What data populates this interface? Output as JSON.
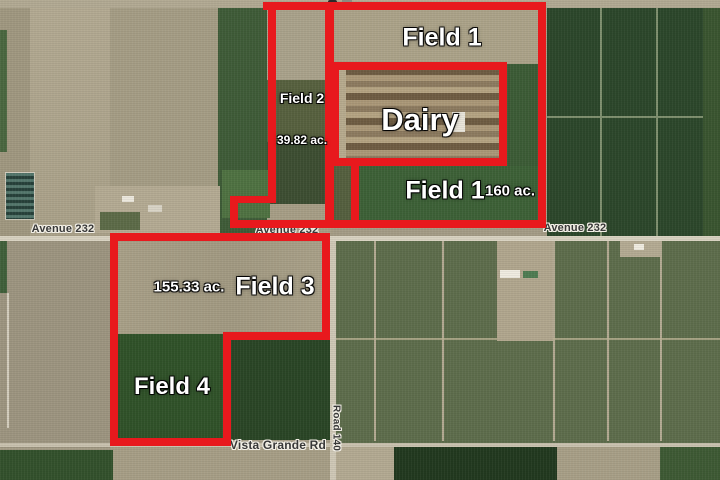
{
  "map": {
    "labels": {
      "field1_top": "Field 1",
      "field2": "Field 2",
      "field2_acreage": "39.82 ac.",
      "dairy": "Dairy",
      "field1_bottom": "Field 1",
      "field1_acreage": "160 ac.",
      "field3": "Field 3",
      "field3_acreage": "155.33 ac.",
      "field4": "Field 4"
    },
    "roads": {
      "avenue232_left": "Avenue 232",
      "avenue232_center": "Avenue 232",
      "avenue232_right": "Avenue 232",
      "vista_grande": "Vista Grande Rd",
      "road140": "Road 140"
    },
    "colors": {
      "boundary_red": "#e8191d",
      "field_label_text": "#ffffff",
      "road_label_text": "#383838",
      "bare_field_tan": "#a9a088",
      "orchard_dark_green": "#2c472b",
      "crop_green": "#3d6137",
      "vineyard_olive": "#5e6d4c",
      "road_surface": "#d8d2c1"
    }
  }
}
